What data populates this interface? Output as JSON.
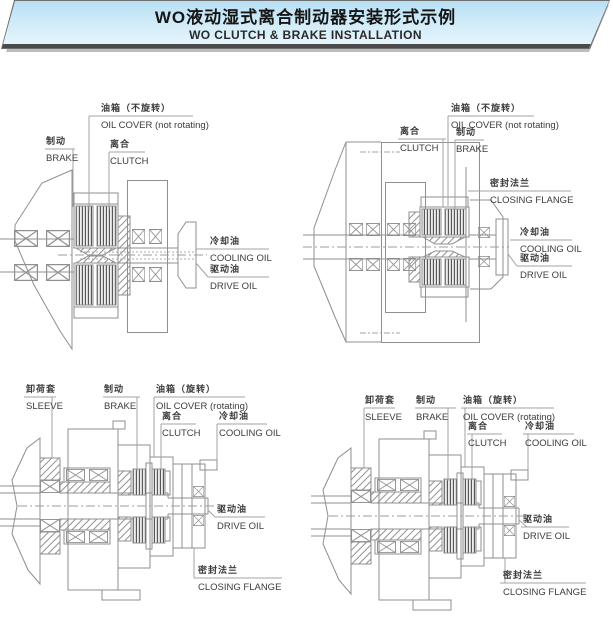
{
  "header": {
    "title_zh": "WO液动湿式离合制动器安装形式示例",
    "title_en": "WO CLUTCH & BRAKE INSTALLATION"
  },
  "figures": [
    {
      "position": "top-left",
      "labels": {
        "brake": {
          "zh": "制动",
          "en": "BRAKE"
        },
        "oil_cover": {
          "zh": "油箱（不旋转）",
          "en": "OIL COVER (not rotating)"
        },
        "clutch": {
          "zh": "离合",
          "en": "CLUTCH"
        },
        "cooling_oil": {
          "zh": "冷却油",
          "en": "COOLING OIL"
        },
        "drive_oil": {
          "zh": "驱动油",
          "en": "DRIVE OIL"
        }
      }
    },
    {
      "position": "top-right",
      "labels": {
        "clutch": {
          "zh": "离合",
          "en": "CLUTCH"
        },
        "oil_cover": {
          "zh": "油箱（不旋转）",
          "en": "OIL COVER (not rotating)"
        },
        "brake": {
          "zh": "制动",
          "en": "BRAKE"
        },
        "closing_flange": {
          "zh": "密封法兰",
          "en": "CLOSING FLANGE"
        },
        "cooling_oil": {
          "zh": "冷却油",
          "en": "COOLING OIL"
        },
        "drive_oil": {
          "zh": "驱动油",
          "en": "DRIVE OIL"
        }
      }
    },
    {
      "position": "bottom-left",
      "labels": {
        "sleeve": {
          "zh": "卸荷套",
          "en": "SLEEVE"
        },
        "brake": {
          "zh": "制动",
          "en": "BRAKE"
        },
        "oil_cover": {
          "zh": "油箱（旋转）",
          "en": "OIL COVER (rotating)"
        },
        "clutch": {
          "zh": "离合",
          "en": "CLUTCH"
        },
        "cooling_oil": {
          "zh": "冷却油",
          "en": "COOLING OIL"
        },
        "drive_oil": {
          "zh": "驱动油",
          "en": "DRIVE OIL"
        },
        "closing_flange": {
          "zh": "密封法兰",
          "en": "CLOSING FLANGE"
        }
      }
    },
    {
      "position": "bottom-right",
      "labels": {
        "sleeve": {
          "zh": "卸荷套",
          "en": "SLEEVE"
        },
        "brake": {
          "zh": "制动",
          "en": "BRAKE"
        },
        "oil_cover": {
          "zh": "油箱（旋转）",
          "en": "OIL COVER (rotating)"
        },
        "clutch": {
          "zh": "离合",
          "en": "CLUTCH"
        },
        "cooling_oil": {
          "zh": "冷却油",
          "en": "COOLING OIL"
        },
        "drive_oil": {
          "zh": "驱动油",
          "en": "DRIVE OIL"
        },
        "closing_flange": {
          "zh": "密封法兰",
          "en": "CLOSING FLANGE"
        }
      }
    }
  ]
}
